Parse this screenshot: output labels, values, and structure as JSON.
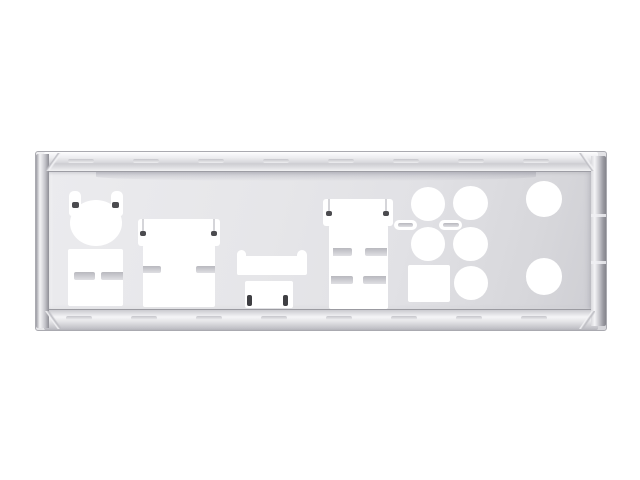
{
  "scene": {
    "kind": "product-photo",
    "subject": "motherboard-rear-io-shield",
    "background_color": "#ffffff"
  },
  "colors": {
    "background": "#ffffff",
    "plate_base": "#e6e6e9",
    "plate_highlight": "#fdfdfe",
    "plate_shadow": "#cfcfd4",
    "edge_line": "#9d9da4",
    "cutout_white": "#ffffff",
    "bar_silver_dark": "#b8b8be",
    "bar_silver_light": "#dfdfe3",
    "slot_dark": "#3f3f43",
    "pin_dot_dark": "#4b4b4f",
    "pin_line_silver": "#d5d5d9",
    "tick_silver": "#c6c6cb"
  },
  "plate": {
    "x": 35,
    "y": 151,
    "width": 572,
    "height": 180,
    "rims": {
      "tick_width": 26,
      "tick_height": 4,
      "top": {
        "tick_y": 7,
        "tick_positions": [
          32,
          97,
          162,
          227,
          292,
          357,
          422,
          487
        ]
      },
      "bottom": {
        "tick_y": 164,
        "tick_positions": [
          30,
          95,
          160,
          225,
          290,
          355,
          420,
          485
        ]
      }
    }
  },
  "cutouts": [
    {
      "name": "ps2-spring-tab-left",
      "kind": "hole",
      "x": 32.5,
      "y": 39,
      "w": 12.5,
      "h": 25,
      "r": "5px 5px 3px 3px"
    },
    {
      "name": "ps2-spring-tab-right",
      "kind": "hole",
      "x": 74.5,
      "y": 39,
      "w": 12.5,
      "h": 25,
      "r": "5px 5px 3px 3px"
    },
    {
      "name": "ps2-port-hole",
      "kind": "hole",
      "x": 34,
      "y": 48,
      "w": 52,
      "h": 46,
      "r": "50%"
    },
    {
      "name": "usb-stack-hole",
      "kind": "hole",
      "x": 31.5,
      "y": 96.5,
      "w": 55,
      "h": 57,
      "r": "2px"
    },
    {
      "name": "dvi1-top-hole",
      "kind": "hole",
      "x": 101.5,
      "y": 66.5,
      "w": 82,
      "h": 27,
      "r": "3px"
    },
    {
      "name": "dvi1-bottom-hole",
      "kind": "hole",
      "x": 106.5,
      "y": 93,
      "w": 72,
      "h": 62,
      "r": "2px"
    },
    {
      "name": "hdmi-ear-left",
      "kind": "hole",
      "x": 200.5,
      "y": 97.5,
      "w": 9.5,
      "h": 25,
      "r": "5px 5px 2px 2px"
    },
    {
      "name": "hdmi-ear-right",
      "kind": "hole",
      "x": 261,
      "y": 97.5,
      "w": 9.5,
      "h": 25,
      "r": "5px 5px 2px 2px"
    },
    {
      "name": "hdmi-bar-hole",
      "kind": "hole",
      "x": 200.5,
      "y": 103.5,
      "w": 70,
      "h": 19,
      "r": "4px"
    },
    {
      "name": "spdif-hole",
      "kind": "hole",
      "x": 208.5,
      "y": 128.5,
      "w": 48.5,
      "h": 27,
      "r": "2px"
    },
    {
      "name": "dvi2-top-hole",
      "kind": "hole",
      "x": 286.5,
      "y": 46.5,
      "w": 70.5,
      "h": 27,
      "r": "3px"
    },
    {
      "name": "dvi2-bottom-hole",
      "kind": "hole",
      "x": 292.5,
      "y": 73,
      "w": 59,
      "h": 84,
      "r": "2px"
    },
    {
      "name": "optical-pill-left",
      "kind": "hole",
      "x": 357.5,
      "y": 67.5,
      "w": 23,
      "h": 10.5,
      "r": "5px"
    },
    {
      "name": "optical-pill-right",
      "kind": "hole",
      "x": 403,
      "y": 67.5,
      "w": 23,
      "h": 10.5,
      "r": "5px"
    },
    {
      "name": "audio-jack-hole-1",
      "kind": "hole",
      "x": 374.5,
      "y": 34.5,
      "w": 34.5,
      "h": 34,
      "r": "50%"
    },
    {
      "name": "audio-jack-hole-2",
      "kind": "hole",
      "x": 417,
      "y": 34,
      "w": 34.5,
      "h": 34,
      "r": "50%"
    },
    {
      "name": "audio-jack-hole-3",
      "kind": "hole",
      "x": 374.5,
      "y": 74.5,
      "w": 34.5,
      "h": 34,
      "r": "50%"
    },
    {
      "name": "audio-jack-hole-4",
      "kind": "hole",
      "x": 417,
      "y": 74.5,
      "w": 34.5,
      "h": 34,
      "r": "50%"
    },
    {
      "name": "audio-jack-hole-5",
      "kind": "hole",
      "x": 418,
      "y": 114,
      "w": 34,
      "h": 33.5,
      "r": "50%"
    },
    {
      "name": "square-hole",
      "kind": "hole",
      "x": 371.5,
      "y": 112.5,
      "w": 42,
      "h": 37,
      "r": "2px"
    },
    {
      "name": "round-hole-top-right",
      "kind": "hole",
      "x": 490,
      "y": 29,
      "w": 35.5,
      "h": 35.5,
      "r": "50%"
    },
    {
      "name": "round-hole-bottom-right",
      "kind": "hole",
      "x": 489.5,
      "y": 106,
      "w": 36,
      "h": 36.5,
      "r": "50%"
    },
    {
      "name": "usb-divider-left",
      "kind": "bar",
      "x": 38,
      "y": 119.5,
      "w": 20.5,
      "h": 8,
      "r": "2px"
    },
    {
      "name": "usb-divider-right",
      "kind": "bar",
      "x": 64.5,
      "y": 119.5,
      "w": 22.5,
      "h": 8,
      "r": "2px 0 0 2px"
    },
    {
      "name": "dvi1-notch-left",
      "kind": "bar",
      "x": 106.5,
      "y": 113.5,
      "w": 18.5,
      "h": 7.5,
      "r": "0 2px 2px 0"
    },
    {
      "name": "dvi1-notch-right",
      "kind": "bar",
      "x": 160,
      "y": 113.5,
      "w": 18.5,
      "h": 7.5,
      "r": "2px 0 0 2px"
    },
    {
      "name": "dvi2-notch-row1-left",
      "kind": "bar",
      "x": 296.5,
      "y": 95.5,
      "w": 19,
      "h": 8,
      "r": "0 2px 2px 0"
    },
    {
      "name": "dvi2-notch-row1-right",
      "kind": "bar",
      "x": 328.5,
      "y": 95.5,
      "w": 22,
      "h": 8,
      "r": "2px 0 0 2px"
    },
    {
      "name": "dvi2-notch-row2-left",
      "kind": "bar",
      "x": 294.5,
      "y": 123.5,
      "w": 22,
      "h": 8.5,
      "r": "0 2px 2px 0"
    },
    {
      "name": "dvi2-notch-row2-right",
      "kind": "bar",
      "x": 327,
      "y": 123.5,
      "w": 23,
      "h": 8.5,
      "r": "2px 0 0 2px"
    },
    {
      "name": "optical-pill-left-bar",
      "kind": "bar",
      "x": 362,
      "y": 70.5,
      "w": 14.5,
      "h": 4.5,
      "r": "2px"
    },
    {
      "name": "optical-pill-right-bar",
      "kind": "bar",
      "x": 406.5,
      "y": 70.5,
      "w": 16,
      "h": 4.5,
      "r": "2px"
    },
    {
      "name": "dvi1-pin-line-left",
      "kind": "line",
      "x": 105.5,
      "y": 67,
      "w": 2,
      "h": 14,
      "r": "0"
    },
    {
      "name": "dvi1-pin-line-right",
      "kind": "line",
      "x": 176.5,
      "y": 67,
      "w": 2,
      "h": 14,
      "r": "0"
    },
    {
      "name": "dvi2-pin-line-left",
      "kind": "line",
      "x": 291.5,
      "y": 47,
      "w": 2,
      "h": 14,
      "r": "0"
    },
    {
      "name": "dvi2-pin-line-right",
      "kind": "line",
      "x": 348.5,
      "y": 47,
      "w": 2,
      "h": 14,
      "r": "0"
    },
    {
      "name": "ps2-tab-pin-left",
      "kind": "dot",
      "x": 35.5,
      "y": 50,
      "w": 7,
      "h": 6,
      "r": "2px"
    },
    {
      "name": "ps2-tab-pin-right",
      "kind": "dot",
      "x": 75.5,
      "y": 50,
      "w": 7,
      "h": 6,
      "r": "2px"
    },
    {
      "name": "dvi1-pin-hole-left",
      "kind": "dot",
      "x": 103.5,
      "y": 79,
      "w": 6,
      "h": 5,
      "r": "2px"
    },
    {
      "name": "dvi1-pin-hole-right",
      "kind": "dot",
      "x": 174.5,
      "y": 79,
      "w": 6,
      "h": 5,
      "r": "2px"
    },
    {
      "name": "dvi2-pin-hole-left",
      "kind": "dot",
      "x": 289.5,
      "y": 59,
      "w": 6,
      "h": 5,
      "r": "2px"
    },
    {
      "name": "dvi2-pin-hole-right",
      "kind": "dot",
      "x": 346.5,
      "y": 59,
      "w": 6,
      "h": 5,
      "r": "2px"
    },
    {
      "name": "spdif-slot-left",
      "kind": "slot",
      "x": 210.5,
      "y": 143,
      "w": 5.5,
      "h": 10.5,
      "r": "2px"
    },
    {
      "name": "spdif-slot-right",
      "kind": "slot",
      "x": 246.5,
      "y": 143,
      "w": 5.5,
      "h": 10.5,
      "r": "2px"
    }
  ]
}
